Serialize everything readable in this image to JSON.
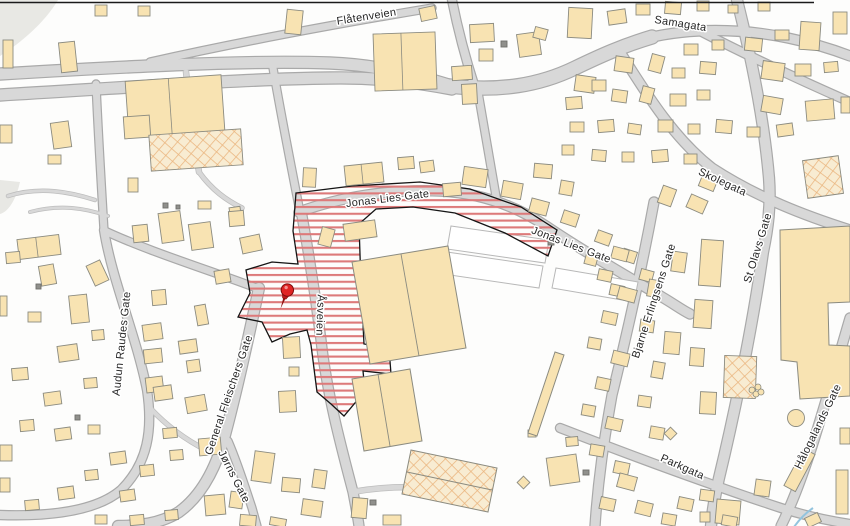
{
  "map": {
    "type": "city-street-map",
    "street_labels": [
      {
        "id": "flatenveien",
        "name": "Flåtenveien"
      },
      {
        "id": "samagata",
        "name": "Samagata"
      },
      {
        "id": "jonas-lies-gate-west",
        "name": "Jonas Lies Gate"
      },
      {
        "id": "jonas-lies-gate-east",
        "name": "Jonas Lies Gate"
      },
      {
        "id": "skolegata",
        "name": "Skolegata"
      },
      {
        "id": "st-olavs-gate",
        "name": "St Olavs Gate"
      },
      {
        "id": "bjarne-erlingsens-gate",
        "name": "Bjarne Erlingsens Gate"
      },
      {
        "id": "halogalands-gate",
        "name": "Hålogalands Gate"
      },
      {
        "id": "parkgata",
        "name": "Parkgata"
      },
      {
        "id": "asveien",
        "name": "Åsveien"
      },
      {
        "id": "general-fleischers-gate",
        "name": "General Fleischers Gate"
      },
      {
        "id": "audun-raudes-gate",
        "name": "Audun Raudes Gate"
      },
      {
        "id": "jorns-gate",
        "name": "Jørns Gate"
      }
    ],
    "marker": {
      "name": "red-pushpin",
      "color": "#e02424"
    },
    "zone": {
      "name": "highlighted-plan-area",
      "outline_color": "#151515",
      "hatch_color": "#dd7a7a",
      "hatch_style": "horizontal-stripes"
    },
    "colors": {
      "background": "#fdfdfc",
      "building_fill": "#f8e3b2",
      "building_outline": "#8b8b80",
      "road_fill": "#d8d8d8",
      "road_outline": "#a9a9a9",
      "crosshatch_fill": "#f8ecd2",
      "crosshatch_line": "#eab57e",
      "label_text": "#262626"
    }
  }
}
